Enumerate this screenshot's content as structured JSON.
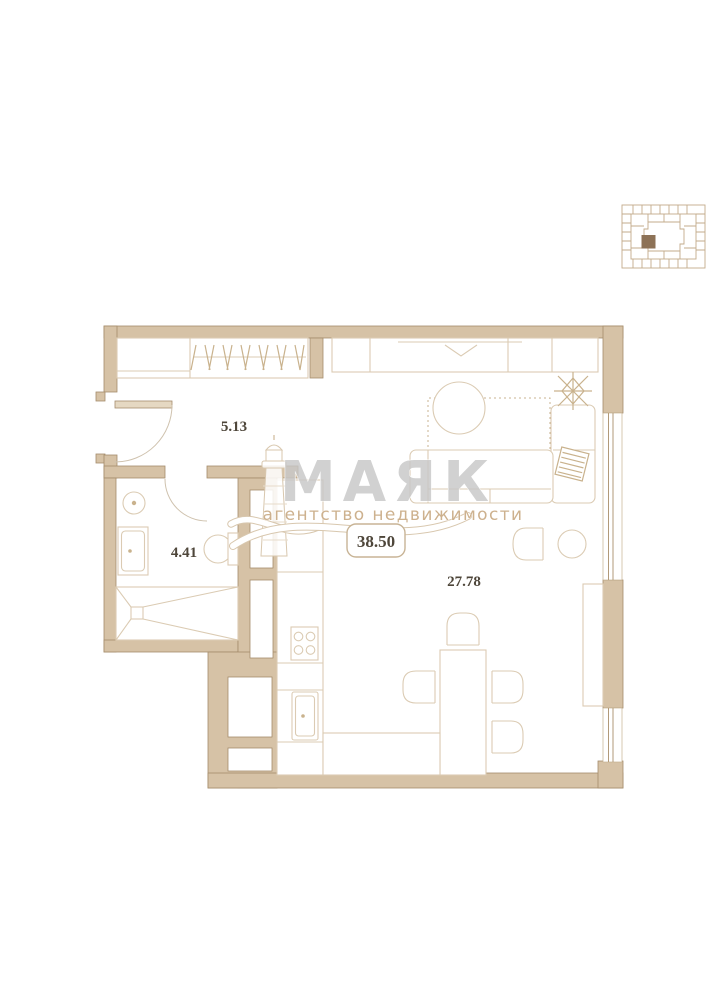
{
  "watermark": {
    "brand": "МАЯК",
    "subtitle": "агентство недвижимости",
    "logo_icon": "lighthouse-icon",
    "brand_color": "#c7c7c7",
    "subtitle_color": "#cdb18e"
  },
  "areas": {
    "hallway": "5.13",
    "bathroom": "4.41",
    "living_kitchen": "27.78",
    "total": "38.50"
  },
  "keyplan": {
    "icon": "building-footprint-icon",
    "highlight_color": "#8d7257",
    "line_color": "#c3ab8b"
  },
  "plan": {
    "wall_color": "#d6c2a6",
    "wall_outline": "#a58c6c",
    "furniture_line": "#dbcbb3",
    "label_color": "#4e463a",
    "label_box_border": "#c8b496"
  },
  "icons": {
    "logo": "lighthouse-icon",
    "unit_location": "building-footprint-icon",
    "decor": "plant-icon"
  }
}
